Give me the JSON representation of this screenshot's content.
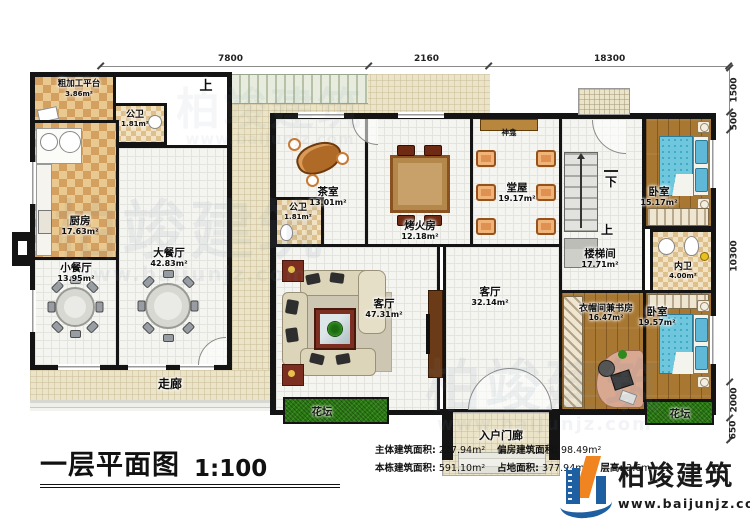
{
  "plan": {
    "dims": {
      "top": [
        "7800",
        "2160",
        "18300"
      ],
      "right": [
        "1500",
        "500",
        "10300",
        "2000",
        "650"
      ]
    },
    "labels": {
      "up": "上",
      "down": "下"
    },
    "rooms": {
      "rough_platform": {
        "name": "粗加工平台",
        "area": "3.86m²"
      },
      "public_bath_left": {
        "name": "公卫",
        "area": "1.81m²"
      },
      "kitchen": {
        "name": "厨房",
        "area": "17.63m²"
      },
      "small_dining": {
        "name": "小餐厅",
        "area": "13.95m²"
      },
      "large_dining": {
        "name": "大餐厅",
        "area": "42.83m²"
      },
      "corridor": {
        "name": "走廊"
      },
      "tea_room": {
        "name": "茶室",
        "area": "13.01m²"
      },
      "public_bath_main": {
        "name": "公卫",
        "area": "1.81m²"
      },
      "fire_room": {
        "name": "烤火房",
        "area": "12.18m²"
      },
      "hall": {
        "name": "堂屋",
        "area": "19.17m²"
      },
      "altar": {
        "name": "神龛"
      },
      "bedroom_top": {
        "name": "卧室",
        "area": "15.17m²"
      },
      "stair_room": {
        "name": "楼梯间",
        "area": "17.71m²"
      },
      "inner_bath": {
        "name": "内卫",
        "area": "4.00m²"
      },
      "living_large": {
        "name": "客厅",
        "area": "47.31m²"
      },
      "living_small": {
        "name": "客厅",
        "area": "32.14m²"
      },
      "cloak_study": {
        "name": "衣帽间兼书房",
        "area": "16.47m²"
      },
      "bedroom_bottom": {
        "name": "卧室",
        "area": "19.57m²"
      },
      "flower_bed_left": {
        "name": "花坛"
      },
      "flower_bed_right": {
        "name": "花坛"
      },
      "entry_porch": {
        "name": "入户门廊"
      }
    }
  },
  "title_block": {
    "title": "一层平面图",
    "scale": "1:100",
    "stats": [
      {
        "label": "主体建筑面积:",
        "value": "227.94m²"
      },
      {
        "label": "偏房建筑面积:",
        "value": "98.49m²"
      },
      {
        "label": "本栋建筑面积:",
        "value": "591.10m²"
      },
      {
        "label": "占地面积:",
        "value": "377.94m²"
      },
      {
        "label": "层高:",
        "value": "3.6m"
      }
    ]
  },
  "logo": {
    "name": "柏竣建筑",
    "url": "www.baijunjz.com"
  }
}
